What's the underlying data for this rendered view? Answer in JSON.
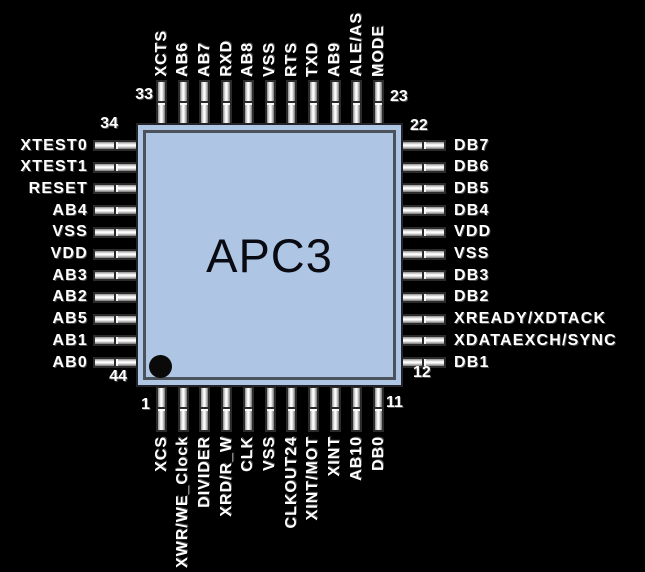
{
  "chip": {
    "name": "APC3"
  },
  "pins": {
    "top": [
      "XCTS",
      "AB6",
      "AB7",
      "RXD",
      "AB8",
      "VSS",
      "RTS",
      "TXD",
      "AB9",
      "ALE/AS",
      "MODE"
    ],
    "right": [
      "DB7",
      "DB6",
      "DB5",
      "DB4",
      "VDD",
      "VSS",
      "DB3",
      "DB2",
      "XREADY/XDTACK",
      "XDATAEXCH/SYNC",
      "DB1"
    ],
    "left": [
      "XTEST0",
      "XTEST1",
      "RESET",
      "AB4",
      "VSS",
      "VDD",
      "AB3",
      "AB2",
      "AB5",
      "AB1",
      "AB0"
    ],
    "bottom": [
      "XCS",
      "XWR/WE_Clock",
      "DIVIDER",
      "XRD/R_W",
      "CLK",
      "VSS",
      "CLKOUT24",
      "XINT/MOT",
      "XINT",
      "AB10",
      "DB0"
    ]
  },
  "pin_numbers": {
    "top": {
      "start": "33",
      "end": "23"
    },
    "left": {
      "start": "34",
      "end": "44"
    },
    "right": {
      "start": "22",
      "end": "12"
    },
    "bottom": {
      "start": "1",
      "end": "11"
    }
  },
  "colors": {
    "background": "#000000",
    "chip_fill": "#aec6e4",
    "chip_border": "#23232a",
    "chip_inner_border": "#4c525c",
    "pin_outline": "#2b2b2b",
    "label_text": "#ffffff",
    "chip_text": "#0a0a12"
  }
}
